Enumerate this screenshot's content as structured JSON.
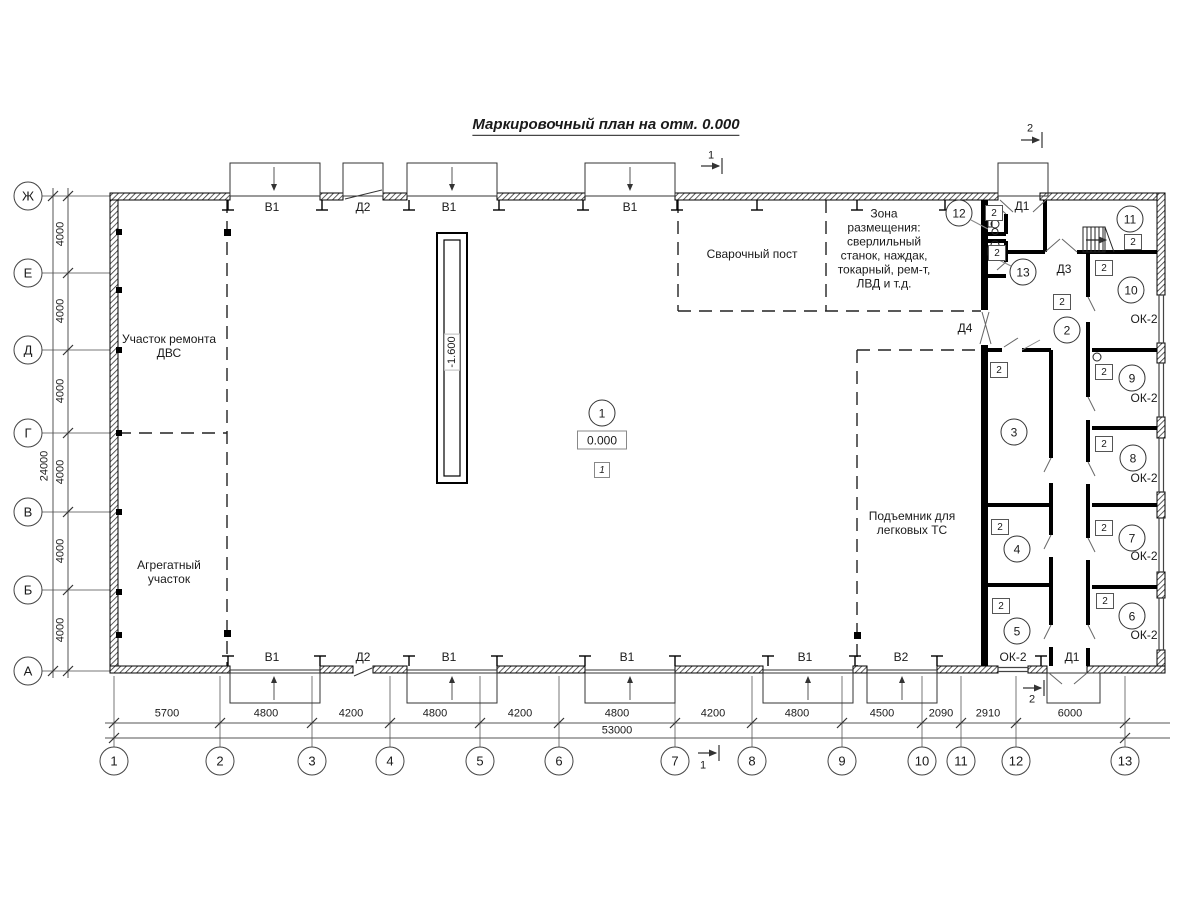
{
  "title": "Маркировочный план на отм. 0.000",
  "axes": {
    "vertical": [
      "Ж",
      "Е",
      "Д",
      "Г",
      "В",
      "Б",
      "А"
    ],
    "horizontal": [
      "1",
      "2",
      "3",
      "4",
      "5",
      "6",
      "7",
      "8",
      "9",
      "10",
      "11",
      "12",
      "13"
    ]
  },
  "dims": {
    "bottom": [
      "5700",
      "4800",
      "4200",
      "4800",
      "4200",
      "4800",
      "4200",
      "4800",
      "4500",
      "2090",
      "2910",
      "6000"
    ],
    "bottom_total": "53000",
    "left_bay": "4000",
    "left_total": "24000"
  },
  "zones": {
    "engine_repair": "Участок ремонта\nДВС",
    "aggregate": "Агрегатный\nучасток",
    "welding": "Сварочный пост",
    "equipment": "Зона\nразмещения:\nсверлильный\nстанок, наждак,\nтокарный, рем-т,\nЛВД и т.д.",
    "lift": "Подъемник для\nлегковых ТС"
  },
  "marks": {
    "elevation": "0.000",
    "pit": "-1.600",
    "detail": "1",
    "floor": "2",
    "window": "ОК-2",
    "b1": "В1",
    "b2": "В2",
    "d1": "Д1",
    "d2": "Д2",
    "d3": "Д3",
    "d4": "Д4",
    "sec1": "1",
    "sec2": "2"
  },
  "rooms": [
    "1",
    "2",
    "3",
    "4",
    "5",
    "6",
    "7",
    "8",
    "9",
    "10",
    "11",
    "12",
    "13"
  ]
}
